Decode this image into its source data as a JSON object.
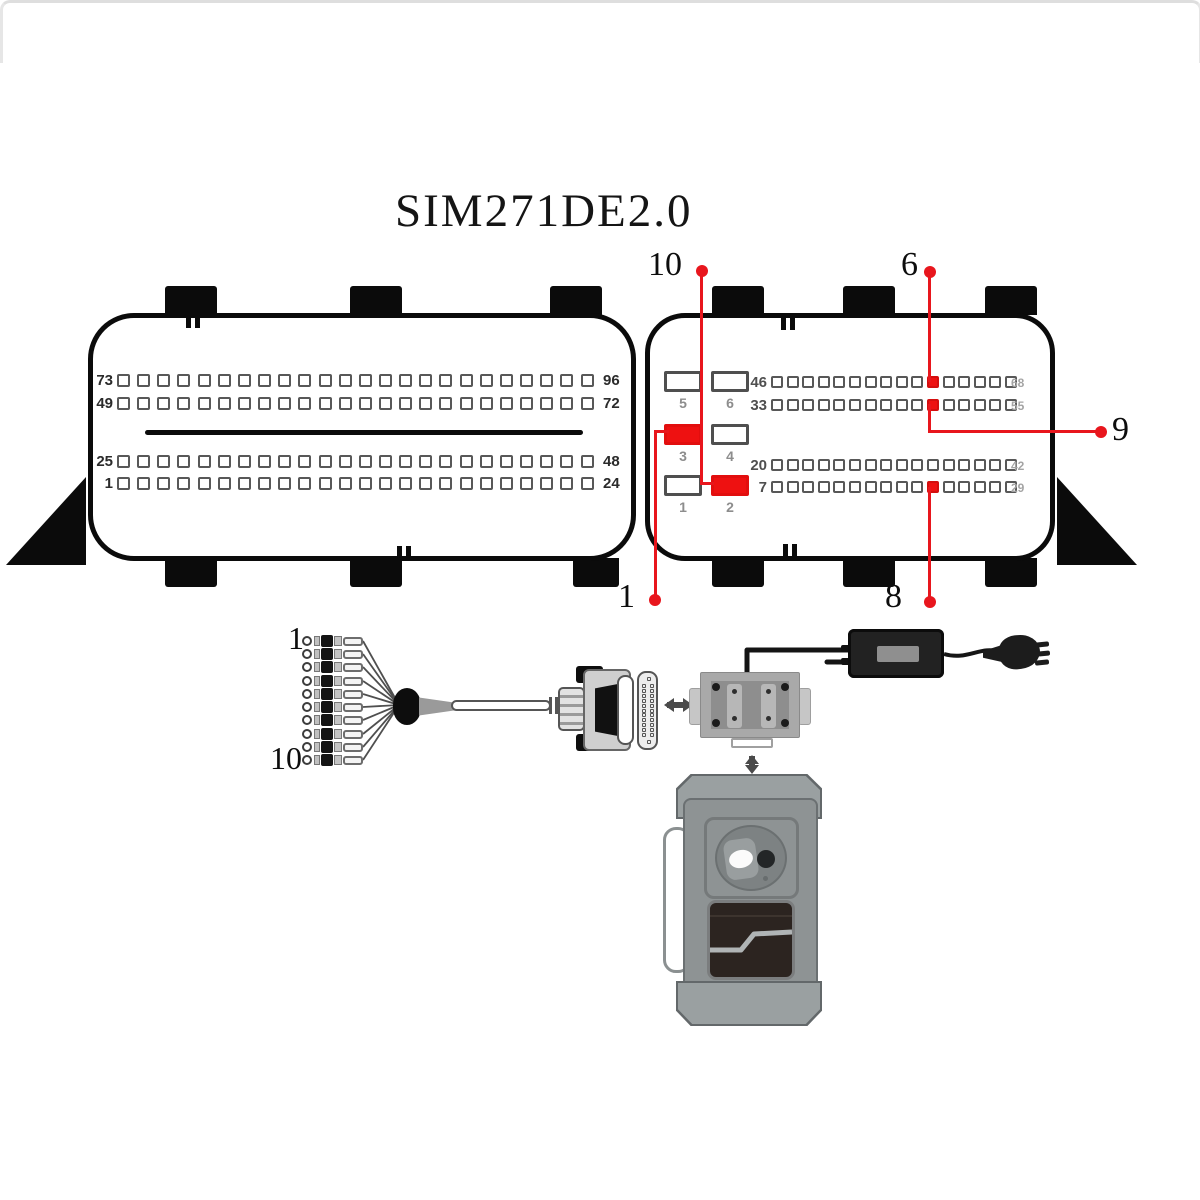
{
  "title": "SIM271DE2.0",
  "colors": {
    "red_line": "#e8161d",
    "red_pad": "#ee1111",
    "outline_black": "#0b0b0b",
    "pin_border_gray": "#585858",
    "device_gray": "#8e9394"
  },
  "left_connector": {
    "rows": [
      {
        "start": "73",
        "end": "96",
        "pins": 24
      },
      {
        "start": "49",
        "end": "72",
        "pins": 24
      },
      {
        "start": "25",
        "end": "48",
        "pins": 24
      },
      {
        "start": "1",
        "end": "24",
        "pins": 24
      }
    ]
  },
  "right_connector": {
    "pads": [
      {
        "label": "5",
        "red": false
      },
      {
        "label": "6",
        "red": false
      },
      {
        "label": "3",
        "red": true
      },
      {
        "label": "4",
        "red": false
      },
      {
        "label": "1",
        "red": false
      },
      {
        "label": "2",
        "red": true
      }
    ],
    "rows": [
      {
        "start": "46",
        "end": "68",
        "pins": 16,
        "red_pin": 11
      },
      {
        "start": "33",
        "end": "55",
        "pins": 16,
        "red_pin": 11
      },
      {
        "start": "20",
        "end": "42",
        "pins": 16,
        "red_pin": null
      },
      {
        "start": "7",
        "end": "29",
        "pins": 16,
        "red_pin": 11
      }
    ]
  },
  "callouts": [
    {
      "label": "10",
      "target": "pad-2"
    },
    {
      "label": "6",
      "target": "row-46-red-pin"
    },
    {
      "label": "9",
      "target": "row-33-red-pin"
    },
    {
      "label": "1",
      "target": "pad-3"
    },
    {
      "label": "8",
      "target": "row-7-red-pin"
    }
  ],
  "harness": {
    "first_lead_label": "1",
    "last_lead_label": "10",
    "leads": 10
  }
}
